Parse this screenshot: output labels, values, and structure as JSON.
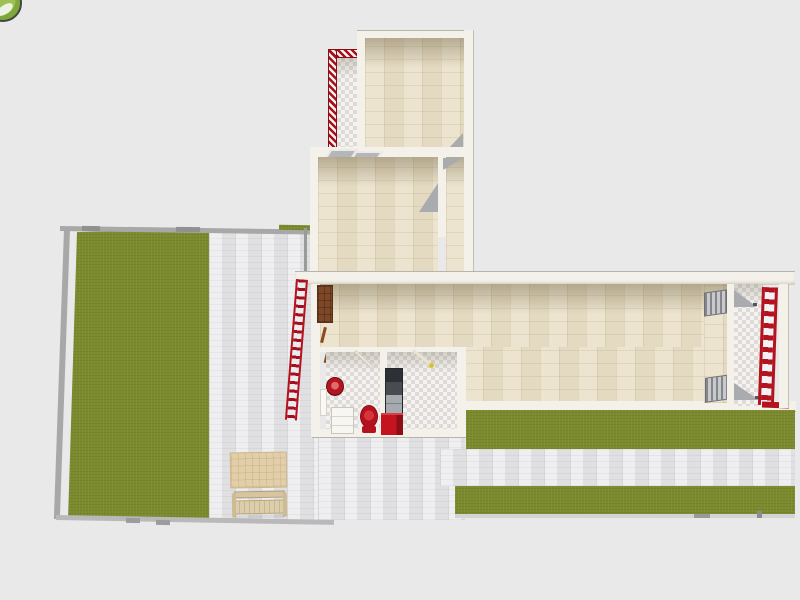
{
  "viewport": {
    "type": "3d-floor-plan-aerial-view",
    "background": "#e9e9e9"
  },
  "palette": {
    "bg": "#e9e9e9",
    "wall": "#f4f1ea",
    "wall-edge": "#b7b4ac",
    "floor-beige": "#eae1ca",
    "floor-line": "#b09a6e",
    "shadow": "#6e5f3e",
    "mosaic-base": "#f4f3f1",
    "mosaic-check": "#dedbd6",
    "lawn": "#7b8a2d",
    "paving": "#e7e7e9",
    "fence": "#a8a8a8",
    "red": "#b3121e",
    "red-dark": "#8d0e17",
    "door-gray": "#b0b3b7",
    "wood": "#7c4827",
    "bench": "#d9c8a4",
    "compass-green": "#8fb544"
  },
  "scene": {
    "controls": [
      {
        "name": "navigation-compass"
      }
    ],
    "rooms": [
      {
        "name": "north-bedroom",
        "floor": "beige-tile"
      },
      {
        "name": "north-balcony",
        "floor": "white-mosaic",
        "railing": "red-white-hatch"
      },
      {
        "name": "middle-room",
        "floor": "beige-tile"
      },
      {
        "name": "middle-corridor",
        "floor": "beige-tile"
      },
      {
        "name": "main-hall",
        "floor": "beige-tile"
      },
      {
        "name": "bathroom-left",
        "floor": "white-mosaic"
      },
      {
        "name": "bathroom-right",
        "floor": "white-mosaic"
      },
      {
        "name": "east-corridor",
        "floor": "beige-tile"
      },
      {
        "name": "east-room",
        "floor": "white-mosaic"
      }
    ],
    "outdoor": [
      {
        "name": "west-lawn",
        "surface": "grass"
      },
      {
        "name": "west-terrace",
        "surface": "paving"
      },
      {
        "name": "south-lawn-upper",
        "surface": "grass"
      },
      {
        "name": "south-path",
        "surface": "paving"
      },
      {
        "name": "south-lawn-lower",
        "surface": "grass"
      }
    ],
    "objects": [
      {
        "name": "west-ladder",
        "color": "red"
      },
      {
        "name": "east-ladder",
        "color": "red"
      },
      {
        "name": "wood-door",
        "color": "brown"
      },
      {
        "name": "wall-mirror",
        "color": "red"
      },
      {
        "name": "toilet",
        "color": "red"
      },
      {
        "name": "white-cabinet",
        "color": "white"
      },
      {
        "name": "refrigerator",
        "color": "gray"
      },
      {
        "name": "red-cabinet",
        "color": "red"
      },
      {
        "name": "garden-bench",
        "color": "tan"
      },
      {
        "name": "picnic-mat",
        "color": "tan"
      },
      {
        "name": "radiator-north",
        "color": "gray"
      },
      {
        "name": "radiator-south",
        "color": "gray"
      },
      {
        "name": "balcony-railing",
        "color": "red-white"
      },
      {
        "name": "window-panels",
        "color": "gray"
      },
      {
        "name": "door-swings",
        "color": "gray"
      }
    ]
  }
}
